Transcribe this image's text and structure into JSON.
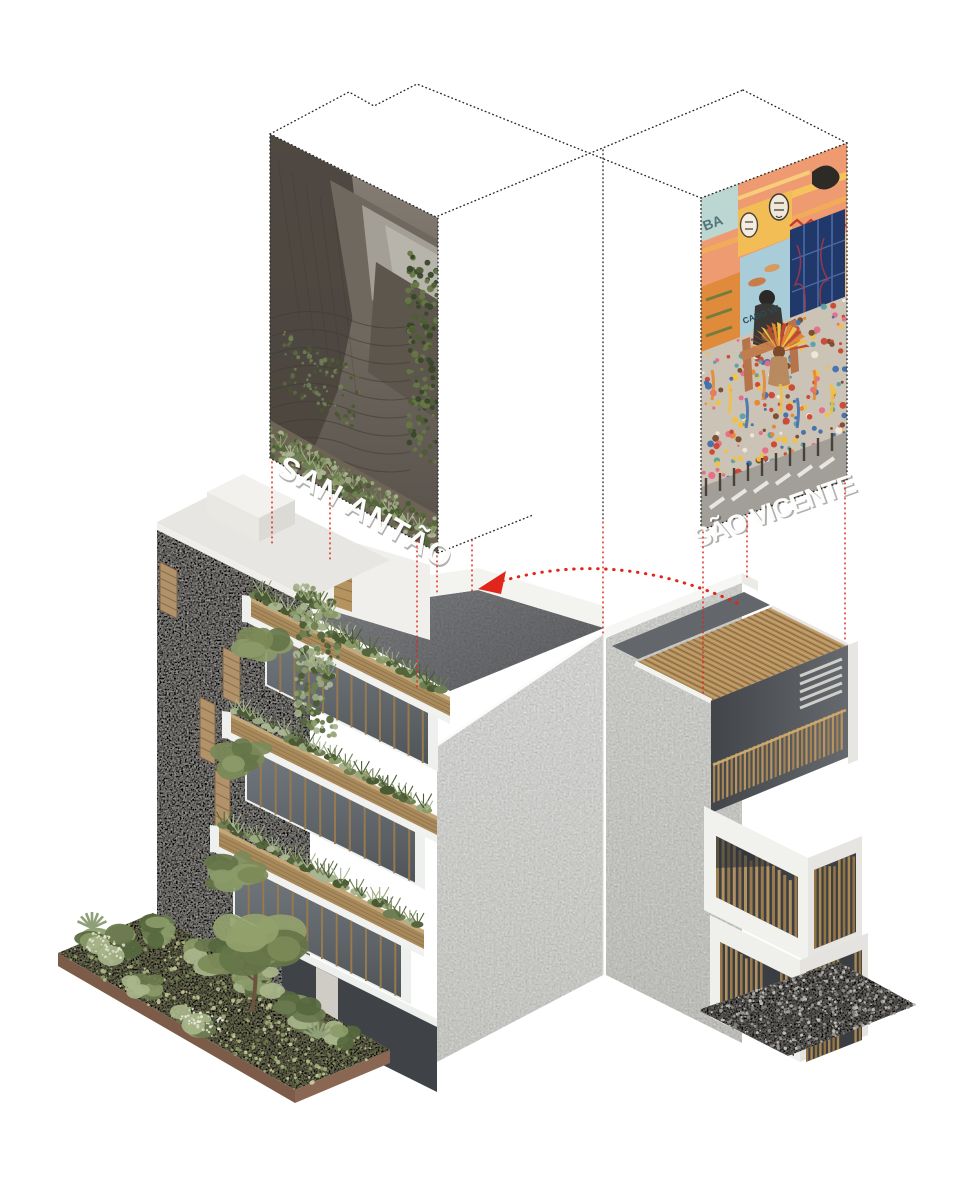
{
  "title": "Axonometric concept diagram — two island houses",
  "panels": {
    "left": {
      "label": "SAN ANTÃO",
      "type": "mountain-terraces-photo"
    },
    "right": {
      "label": "SÃO VICENTE",
      "type": "carnival-mural-photo",
      "graffiti_left": "BA",
      "graffiti_center": "CABO VE"
    }
  },
  "arrow": {
    "meaning": "transfer-from-sao-vicente-to-san-antao"
  },
  "colors": {
    "outline_black": "#2b2b2b",
    "projection_red": "#e0261a",
    "terrace_gray": "#85878a",
    "concrete": "#dbd8d2",
    "wood": "#b2915e",
    "glass": "#5f6569",
    "grass": "#b2b389",
    "soil": "#7d5b49"
  }
}
